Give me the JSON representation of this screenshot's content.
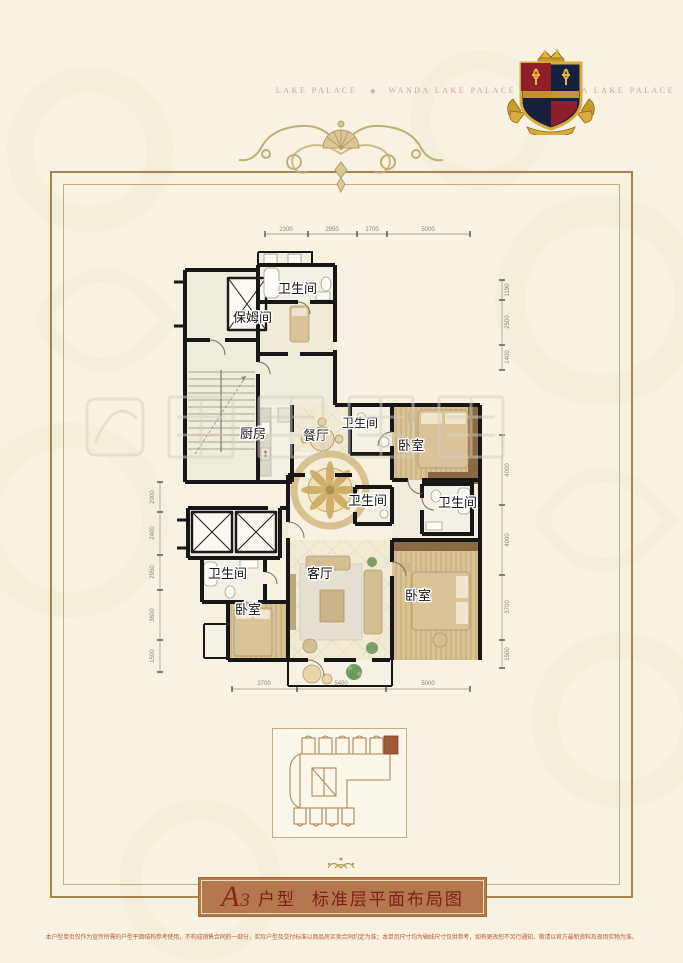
{
  "header": {
    "ribbon": {
      "segments": [
        "LAKE PALACE",
        "WANDA LAKE PALACE",
        "WANDA LAKE PALACE"
      ],
      "separator": "◆"
    }
  },
  "floorplan": {
    "labels": {
      "bathroom": "卫生间",
      "nanny_room": "保姆间",
      "kitchen": "厨房",
      "dining_room": "餐厅",
      "bedroom": "卧室",
      "living_room": "客厅"
    },
    "dims": {
      "top": [
        "2300",
        "2950",
        "1700",
        "5000"
      ],
      "bottom": [
        "3700",
        "5400",
        "5000"
      ],
      "right_upper": [
        "1190",
        "2500",
        "1400"
      ],
      "right_lower": [
        "4000",
        "4000",
        "3700",
        "1500"
      ],
      "left": [
        "2000",
        "2400",
        "2950",
        "3600",
        "1500"
      ]
    }
  },
  "banner": {
    "unit_letter": "A",
    "unit_number": "3",
    "unit_word": "户型",
    "title": "标准层平面布局图"
  },
  "footer": {
    "disclaimer": "本户型单页仅作为宣传所需的户型平面结构参考使用，不构成销售合同的一部分，实际户型及交付标准以商品房买卖合同约定为准；本单页尺寸均为轴线尺寸仅供参考，如有更改恕不另行通知，敬请以官方最新资料及现场实物为准。"
  },
  "colors": {
    "ribbon_red": "#8e2630",
    "banner_fill": "#b5774e",
    "banner_text": "#7c2014",
    "gold": "#c9ab6b",
    "highlight_unit": "#9e5b33"
  }
}
